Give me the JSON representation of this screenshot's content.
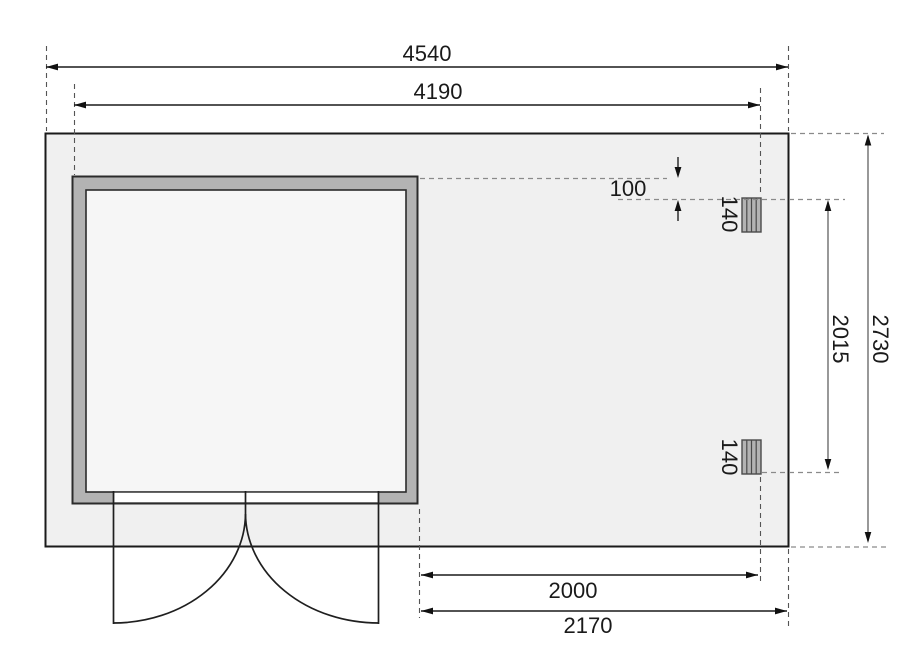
{
  "dims": {
    "total_width": "4540",
    "shed_outer_width": "4190",
    "total_depth": "2730",
    "post_span": "2015",
    "roof_offset": "100",
    "post_size_top": "140",
    "post_size_bottom": "140",
    "annex_width_inner": "2000",
    "annex_width_outer": "2170"
  },
  "colors": {
    "plate_fill": "#f0f0f0",
    "room_fill": "#f6f6f6",
    "wall_fill": "#b3b3b3",
    "post_fill": "#b3b3b3",
    "threshold_fill": "#ffffff"
  }
}
